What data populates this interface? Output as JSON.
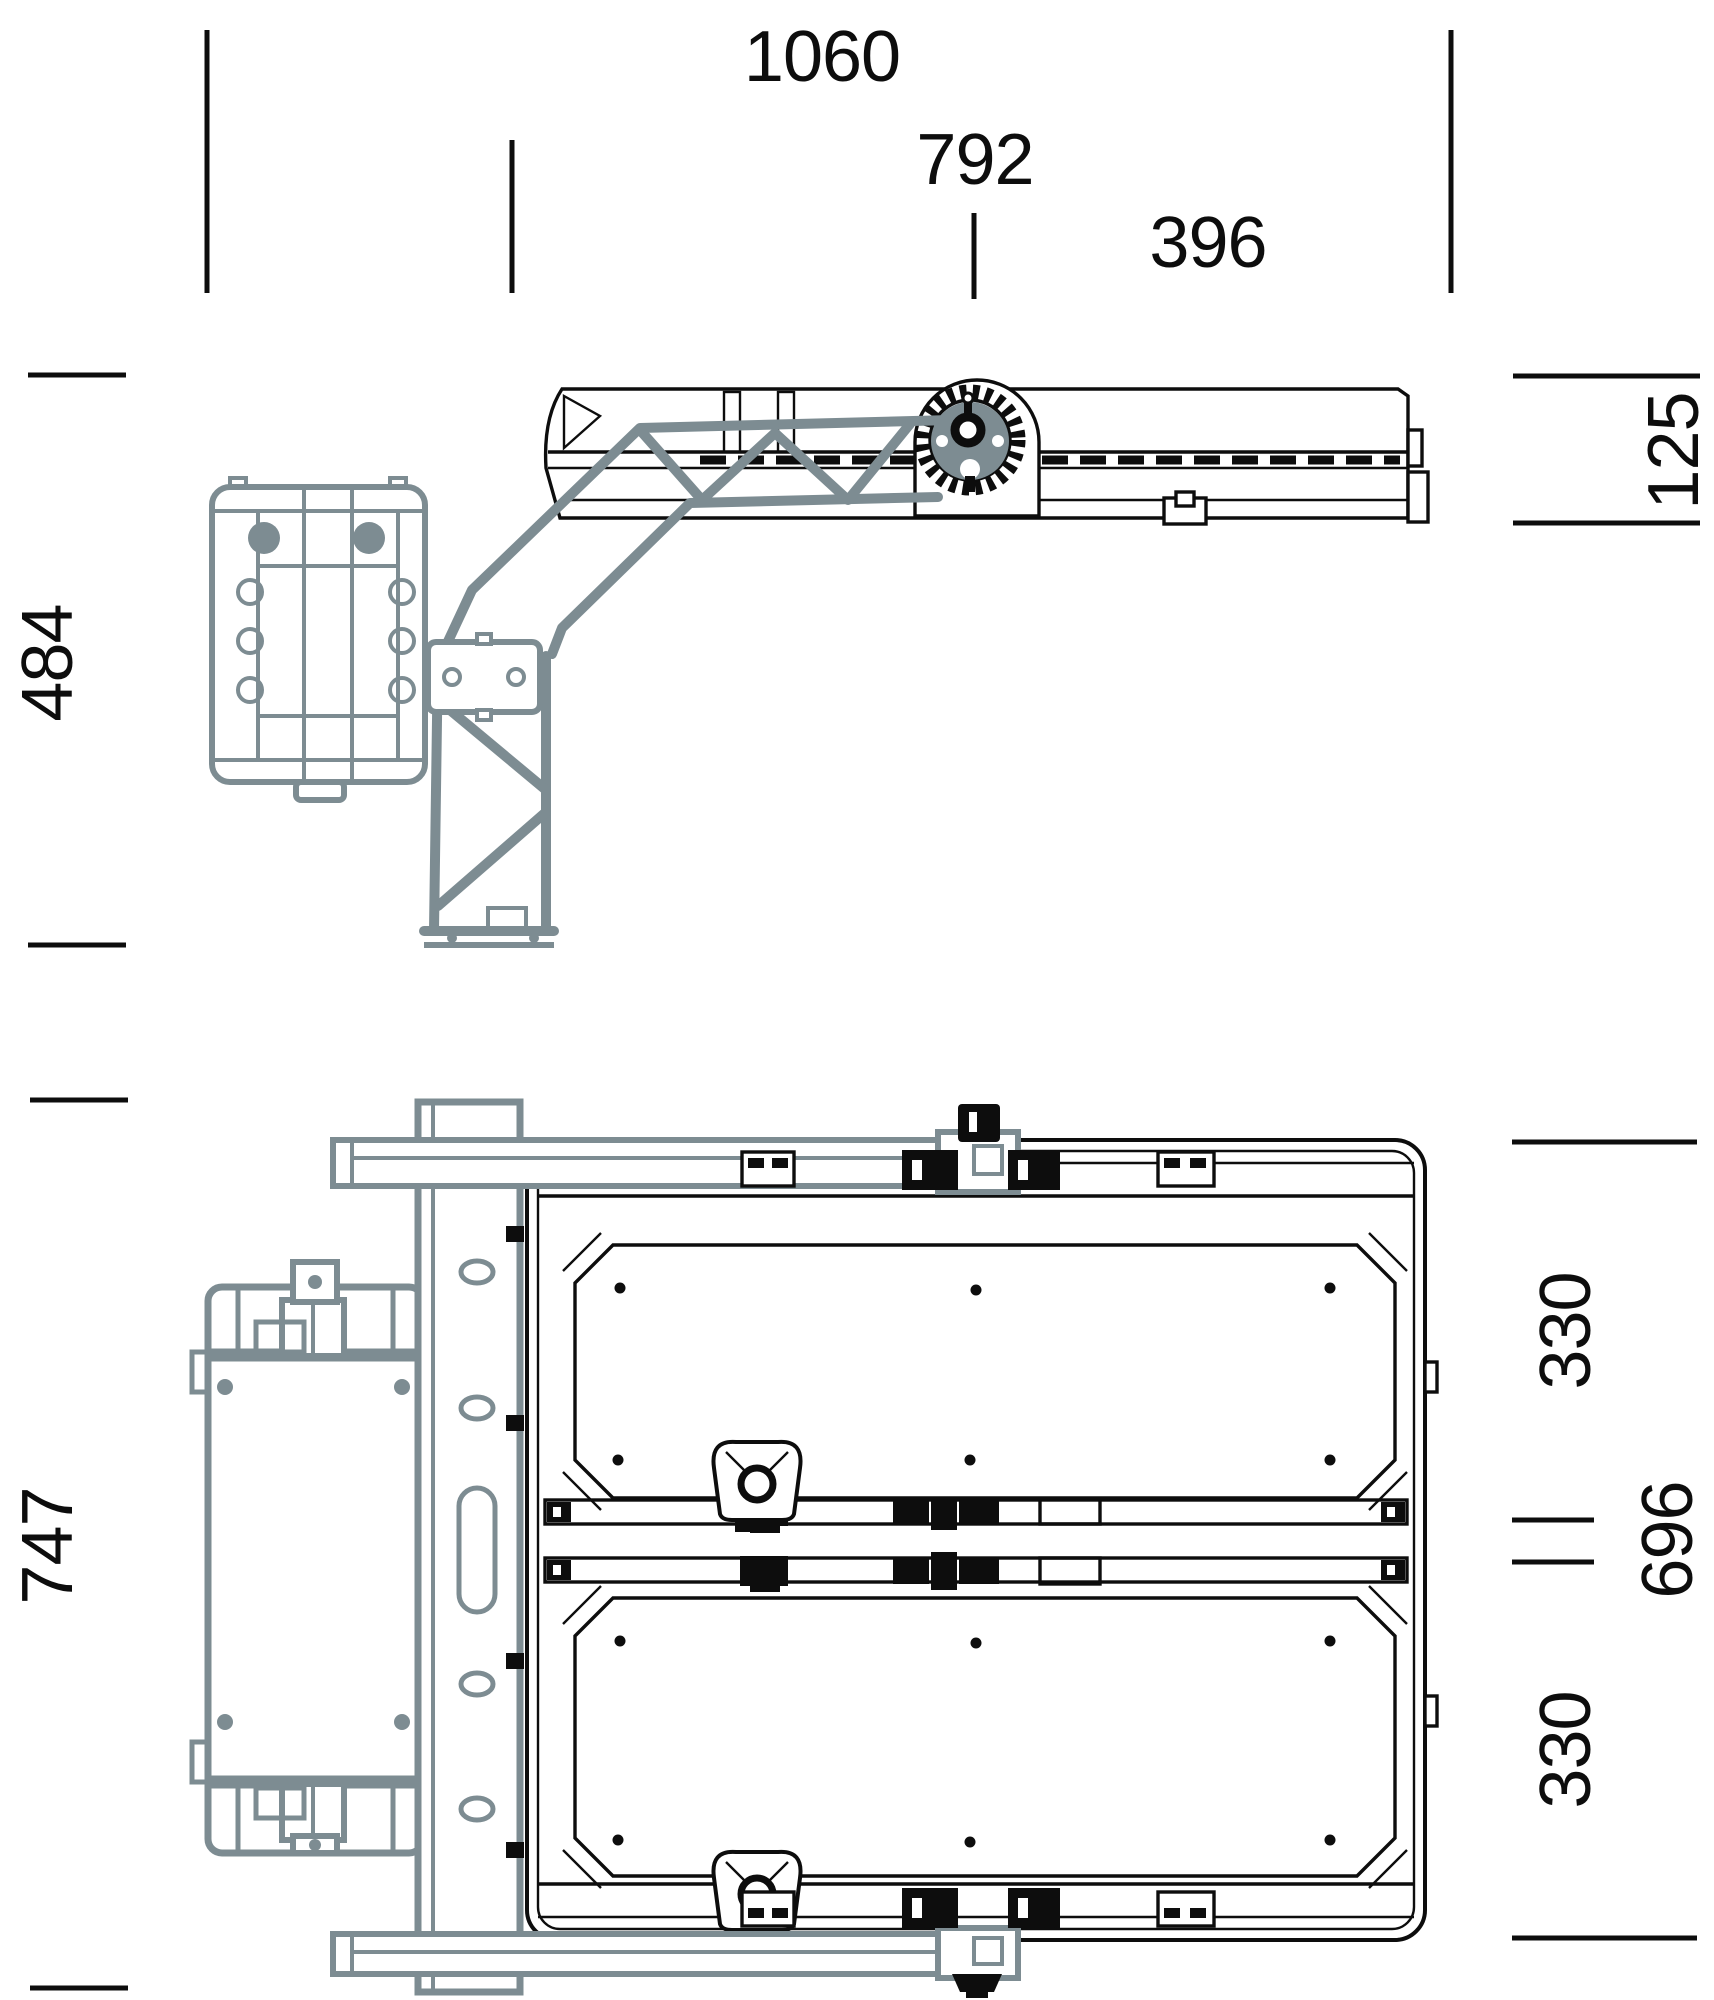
{
  "colors": {
    "ink": "#0d0d0d",
    "bracket": "#7d8c92",
    "background": "#ffffff"
  },
  "dimensions": {
    "overall_width": {
      "label": "1060"
    },
    "bracket_offset_width": {
      "label": "792"
    },
    "half_width": {
      "label": "396"
    },
    "side_overall_height": {
      "label": "484"
    },
    "housing_thickness": {
      "label": "125"
    },
    "rear_overall_height": {
      "label": "747"
    },
    "upper_module_height": {
      "label": "330"
    },
    "frame_height": {
      "label": "696"
    },
    "lower_module_height": {
      "label": "330"
    }
  }
}
